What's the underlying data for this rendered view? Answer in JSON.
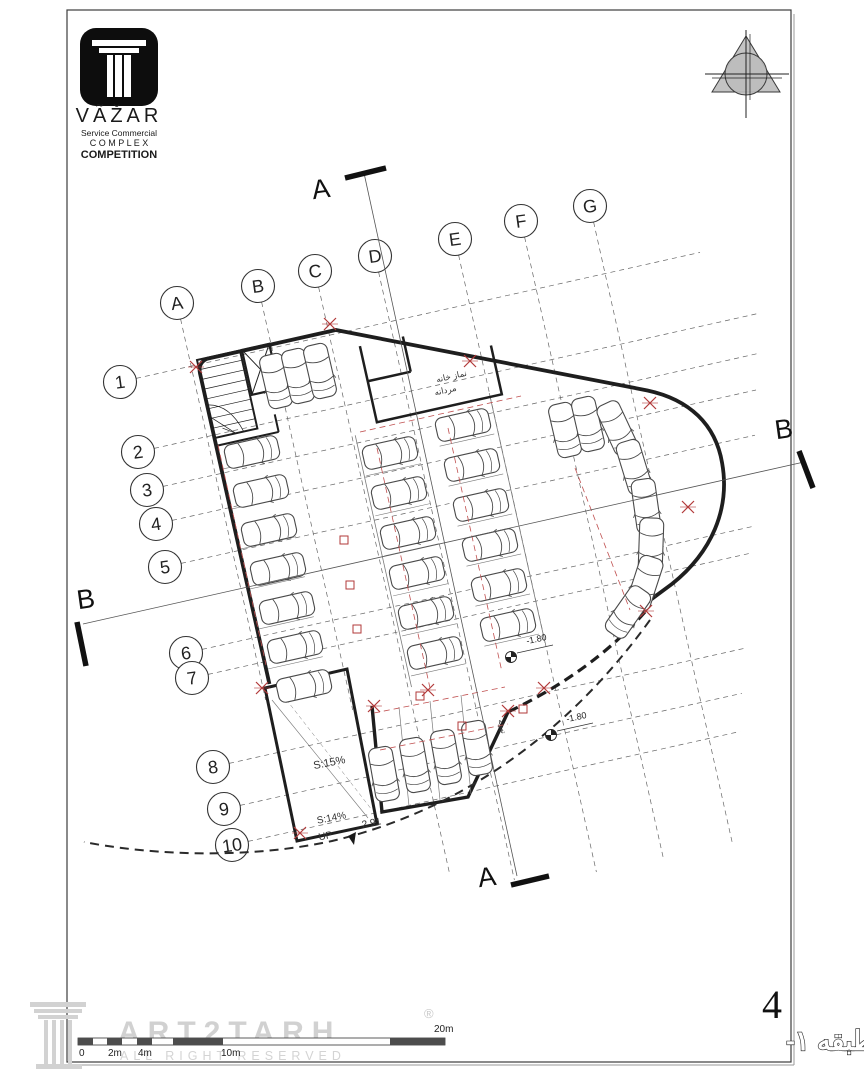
{
  "sheet": {
    "bg": "#ffffff",
    "frame_color": "#3c3c3c",
    "shadow_color": "#9a9a9a"
  },
  "logo": {
    "brand": "VÃŽAR",
    "subtitle": "Service Commercial",
    "complex": "C O M P L E X",
    "competition": "COMPETITION",
    "box_color": "#0d0d0d"
  },
  "north_arrow": {
    "x": 746,
    "y": 74,
    "fill": "#bdbdbd"
  },
  "grid": {
    "slope": 0.2234,
    "letters": [
      {
        "label": "A",
        "cx": 177,
        "cy": 303,
        "ey": 700
      },
      {
        "label": "B",
        "cx": 258,
        "cy": 286,
        "ey": 710
      },
      {
        "label": "C",
        "cx": 315,
        "cy": 271,
        "ey": 875
      },
      {
        "label": "D",
        "cx": 375,
        "cy": 256,
        "ey": 880
      },
      {
        "label": "E",
        "cx": 455,
        "cy": 239,
        "ey": 872
      },
      {
        "label": "F",
        "cx": 521,
        "cy": 221,
        "ey": 858
      },
      {
        "label": "G",
        "cx": 590,
        "cy": 206,
        "ey": 842
      }
    ],
    "numbers": [
      {
        "label": "1",
        "cx": 120,
        "cy": 382,
        "ex": 700
      },
      {
        "label": "2",
        "cx": 138,
        "cy": 452,
        "ex": 758
      },
      {
        "label": "3",
        "cx": 147,
        "cy": 490,
        "ex": 758
      },
      {
        "label": "4",
        "cx": 156,
        "cy": 524,
        "ex": 756
      },
      {
        "label": "5",
        "cx": 165,
        "cy": 567,
        "ex": 755
      },
      {
        "label": "6",
        "cx": 186,
        "cy": 653,
        "ex": 752
      },
      {
        "label": "7",
        "cx": 192,
        "cy": 678,
        "ex": 750
      },
      {
        "label": "8",
        "cx": 213,
        "cy": 767,
        "ex": 745
      },
      {
        "label": "9",
        "cx": 224,
        "cy": 809,
        "ex": 742
      },
      {
        "label": "10",
        "cx": 232,
        "cy": 845,
        "ex": 740
      }
    ]
  },
  "sections": [
    {
      "label": "A",
      "tx": 322,
      "ty": 198,
      "rot": -8,
      "bar": [
        345,
        178,
        386,
        168
      ],
      "line": [
        364,
        173,
        517,
        876
      ]
    },
    {
      "label": "A",
      "tx": 488,
      "ty": 886,
      "rot": -8,
      "bar": [
        511,
        885,
        549,
        876
      ],
      "line": null
    },
    {
      "label": "B",
      "tx": 87,
      "ty": 608,
      "rot": -8,
      "bar": [
        77,
        622,
        86,
        666
      ],
      "line": [
        83,
        624,
        804,
        462
      ]
    },
    {
      "label": "B",
      "tx": 785,
      "ty": 438,
      "rot": -8,
      "bar": [
        799,
        451,
        813,
        488
      ],
      "line": null
    }
  ],
  "plan": {
    "rotation": -12.6,
    "tx": 197,
    "ty": 360,
    "cars": [
      [
        252,
        452,
        -12.6
      ],
      [
        261,
        491,
        -12.6
      ],
      [
        269,
        530,
        -12.6
      ],
      [
        278,
        569,
        -12.6
      ],
      [
        287,
        608,
        -12.6
      ],
      [
        295,
        647,
        -12.6
      ],
      [
        304,
        686,
        -12.6
      ],
      [
        276,
        381,
        77
      ],
      [
        298,
        376,
        77
      ],
      [
        320,
        371,
        77
      ],
      [
        390,
        453,
        -12.6
      ],
      [
        399,
        493,
        -12.6
      ],
      [
        408,
        533,
        -12.6
      ],
      [
        417,
        573,
        -12.6
      ],
      [
        426,
        613,
        -12.6
      ],
      [
        435,
        653,
        -12.6
      ],
      [
        463,
        425,
        -12.6
      ],
      [
        472,
        465,
        -12.6
      ],
      [
        481,
        505,
        -12.6
      ],
      [
        490,
        545,
        -12.6
      ],
      [
        499,
        585,
        -12.6
      ],
      [
        508,
        625,
        -12.6
      ],
      [
        565,
        430,
        77
      ],
      [
        588,
        424,
        77
      ],
      [
        617,
        428,
        65
      ],
      [
        634,
        467,
        73
      ],
      [
        646,
        506,
        82
      ],
      [
        651,
        545,
        92
      ],
      [
        645,
        583,
        108
      ],
      [
        628,
        612,
        125
      ],
      [
        384,
        774,
        80
      ],
      [
        415,
        765,
        80
      ],
      [
        446,
        757,
        80
      ],
      [
        477,
        748,
        80
      ]
    ],
    "labels": [
      {
        "t": "نماز خانه",
        "x": 452,
        "y": 379,
        "r": -12.6,
        "s": 8.5
      },
      {
        "t": "مردانه",
        "x": 446,
        "y": 393,
        "r": -12.6,
        "s": 8.5
      },
      {
        "t": "S:15%",
        "x": 330,
        "y": 766,
        "r": -11,
        "s": 11
      },
      {
        "t": "S:14%",
        "x": 332,
        "y": 821,
        "r": -11,
        "s": 10
      },
      {
        "t": "2.91",
        "x": 372,
        "y": 826,
        "r": -11,
        "s": 10
      },
      {
        "t": "UP",
        "x": 326,
        "y": 839,
        "r": -11,
        "s": 10
      },
      {
        "t": "تهویه",
        "x": 500,
        "y": 727,
        "r": 77,
        "s": 7
      }
    ],
    "levels": [
      {
        "t": "-1.80",
        "x": 511,
        "y": 657
      },
      {
        "t": "-1.80",
        "x": 551,
        "y": 735
      }
    ],
    "red": {
      "crosses": [
        [
          330,
          324
        ],
        [
          470,
          361
        ],
        [
          196,
          367
        ],
        [
          650,
          403
        ],
        [
          646,
          611
        ],
        [
          508,
          711
        ],
        [
          300,
          833
        ],
        [
          374,
          706
        ],
        [
          688,
          507
        ],
        [
          544,
          688
        ],
        [
          428,
          690
        ],
        [
          262,
          688
        ]
      ],
      "squares": [
        [
          344,
          540
        ],
        [
          350,
          585
        ],
        [
          420,
          696
        ],
        [
          462,
          726
        ],
        [
          523,
          709
        ],
        [
          357,
          629
        ]
      ],
      "dashes": [
        [
          218,
          445,
          266,
          665
        ],
        [
          377,
          448,
          430,
          688
        ],
        [
          448,
          428,
          502,
          672
        ],
        [
          360,
          432,
          521,
          396
        ],
        [
          374,
          713,
          505,
          687
        ],
        [
          380,
          750,
          508,
          724
        ],
        [
          575,
          468,
          630,
          610
        ]
      ]
    }
  },
  "titleblock": {
    "number": "4",
    "title": "پلان اندازه گذاری طبقه ۱-"
  },
  "scalebar": {
    "bar": {
      "x1": 78,
      "x2": 445,
      "y": 1038,
      "h": 7
    },
    "darks": [
      [
        78,
        93
      ],
      [
        107,
        122
      ],
      [
        137,
        152
      ],
      [
        173,
        223
      ],
      [
        390,
        445
      ]
    ],
    "below": [
      {
        "t": "0",
        "x": 79
      },
      {
        "t": "2m",
        "x": 108
      },
      {
        "t": "4m",
        "x": 138
      },
      {
        "t": "10m",
        "x": 221
      }
    ],
    "above": {
      "t": "20m",
      "x": 434
    }
  },
  "watermark": {
    "name": "ART2TARH",
    "reg": "®",
    "sub": "ALL RIGHT RESERVED",
    "color": "#c9c9c9"
  }
}
